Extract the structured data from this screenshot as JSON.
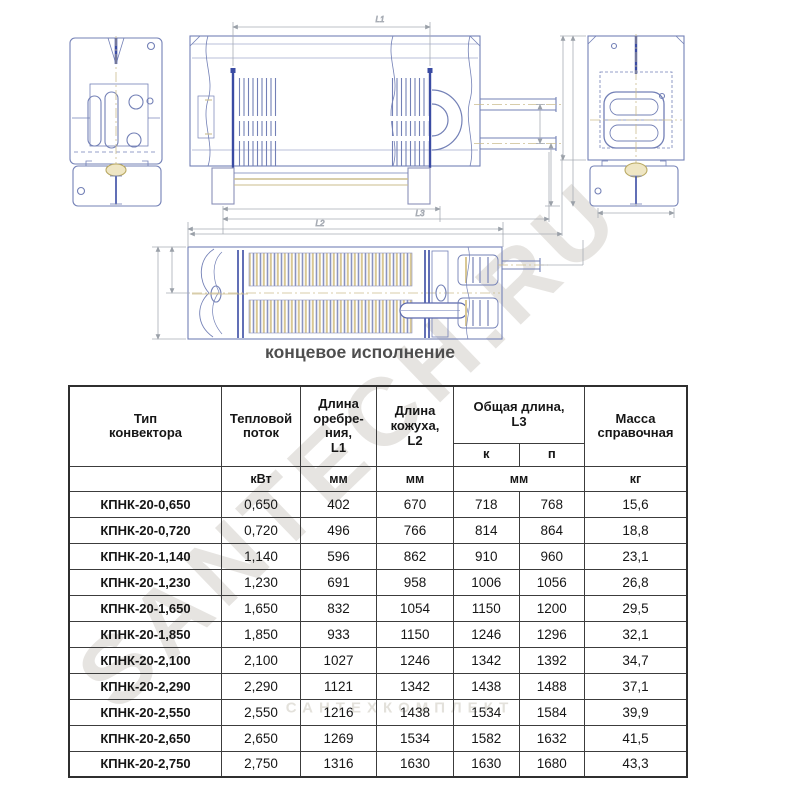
{
  "watermark": {
    "text": "SANTECH.RU",
    "small_text": "САНТЕХКОМПЛЕКТ"
  },
  "caption": "концевое исполнение",
  "drawing": {
    "dims": {
      "l1": "L1",
      "l2": "L2",
      "l3": "L3"
    }
  },
  "colors": {
    "drawing_line": "#7380b6",
    "drawing_dark": "#3a4ba3",
    "centerline_tan": "#cbbd8e",
    "dimension_gray": "#a8adb5",
    "table_border": "#3c3c3c",
    "watermark": "#b5ada0"
  },
  "table": {
    "headers": {
      "type": "Тип\nконвектора",
      "heat": "Тепловой\nпоток",
      "fin_length": "Длина\nоребре-\nния,\nL1",
      "casing_length": "Длина\nкожуха,\nL2",
      "total_length": "Общая длина,\nL3",
      "sub_k": "к",
      "sub_p": "п",
      "mass": "Масса\nсправочная"
    },
    "units": {
      "heat": "кВт",
      "fin": "мм",
      "casing": "мм",
      "total": "мм",
      "mass": "кг"
    },
    "rows": [
      {
        "cells": [
          "КПНК-20-0,650",
          "0,650",
          "402",
          "670",
          "718",
          "768",
          "15,6"
        ]
      },
      {
        "cells": [
          "КПНК-20-0,720",
          "0,720",
          "496",
          "766",
          "814",
          "864",
          "18,8"
        ]
      },
      {
        "cells": [
          "КПНК-20-1,140",
          "1,140",
          "596",
          "862",
          "910",
          "960",
          "23,1"
        ]
      },
      {
        "cells": [
          "КПНК-20-1,230",
          "1,230",
          "691",
          "958",
          "1006",
          "1056",
          "26,8"
        ]
      },
      {
        "cells": [
          "КПНК-20-1,650",
          "1,650",
          "832",
          "1054",
          "1150",
          "1200",
          "29,5"
        ]
      },
      {
        "cells": [
          "КПНК-20-1,850",
          "1,850",
          "933",
          "1150",
          "1246",
          "1296",
          "32,1"
        ]
      },
      {
        "cells": [
          "КПНК-20-2,100",
          "2,100",
          "1027",
          "1246",
          "1342",
          "1392",
          "34,7"
        ]
      },
      {
        "cells": [
          "КПНК-20-2,290",
          "2,290",
          "1121",
          "1342",
          "1438",
          "1488",
          "37,1"
        ]
      },
      {
        "cells": [
          "КПНК-20-2,550",
          "2,550",
          "1216",
          "1438",
          "1534",
          "1584",
          "39,9"
        ]
      },
      {
        "cells": [
          "КПНК-20-2,650",
          "2,650",
          "1269",
          "1534",
          "1582",
          "1632",
          "41,5"
        ]
      },
      {
        "cells": [
          "КПНК-20-2,750",
          "2,750",
          "1316",
          "1630",
          "1630",
          "1680",
          "43,3"
        ]
      }
    ]
  }
}
